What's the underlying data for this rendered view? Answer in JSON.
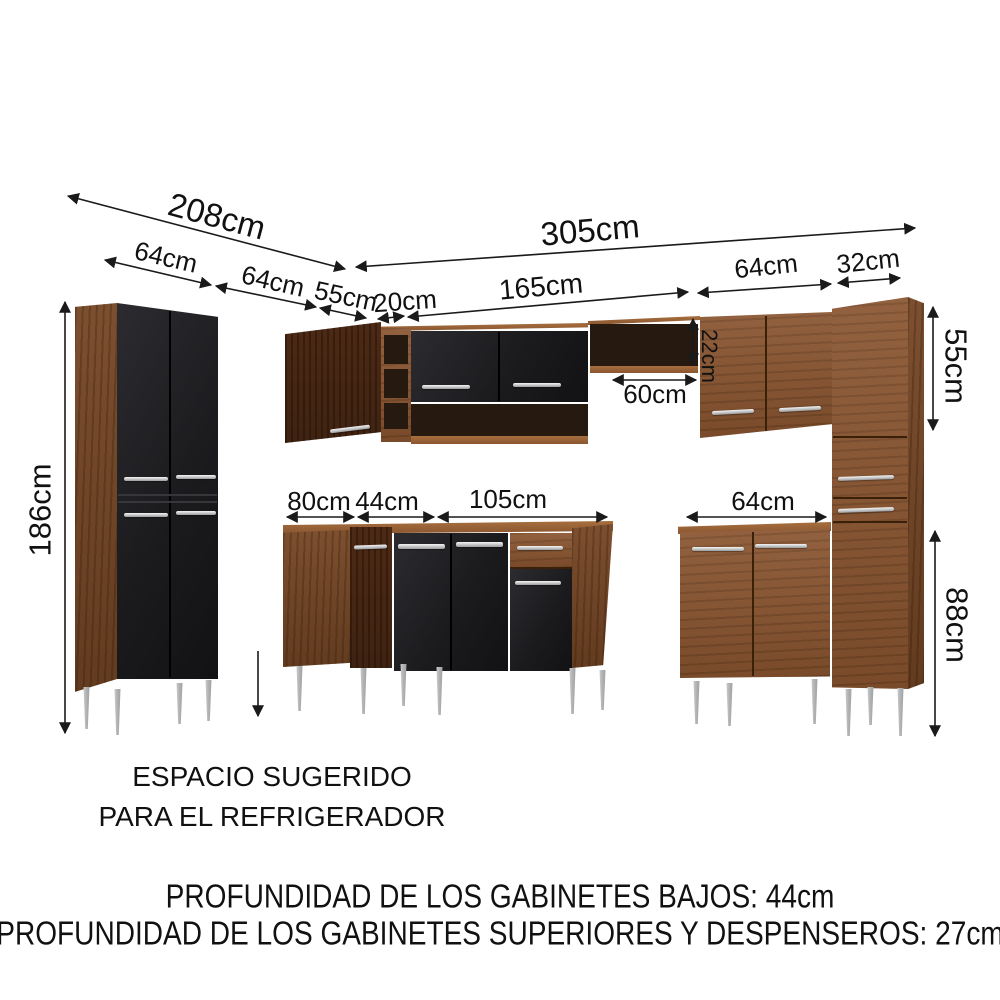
{
  "diagram": {
    "type": "kitchen-cabinet-dimension-diagram",
    "dims": {
      "left_run_total": "208cm",
      "pantry_width": "64cm",
      "fridge_space_width": "64cm",
      "corner_upper_width": "55cm",
      "corner_filler_width": "20cm",
      "center_upper_width": "165cm",
      "right_upper_width": "64cm",
      "tall_side_width": "32cm",
      "right_run_total": "305cm",
      "pantry_height": "186cm",
      "niche_height": "22cm",
      "niche_width": "60cm",
      "upper_cabinet_height": "55cm",
      "base_corner_left_width": "80cm",
      "base_corner_front_width": "44cm",
      "base_center_width": "105cm",
      "base_right_width": "64cm",
      "base_cabinet_height": "88cm"
    },
    "notes": {
      "fridge_line1": "ESPACIO SUGERIDO",
      "fridge_line2": "PARA EL REFRIGERADOR",
      "depth_base": "PROFUNDIDAD DE LOS GABINETES BAJOS: 44cm",
      "depth_upper": "PROFUNDIDAD DE LOS GABINETES SUPERIORES Y DESPENSEROS: 27cm"
    },
    "colors": {
      "wood": "#8a5530",
      "wood_dark": "#754624",
      "wood_deep": "#573018",
      "black_door": "#1b1b1e",
      "handle": "#c9cacc",
      "leg": "#b5b6b8",
      "line": "#1a1a1a"
    }
  }
}
